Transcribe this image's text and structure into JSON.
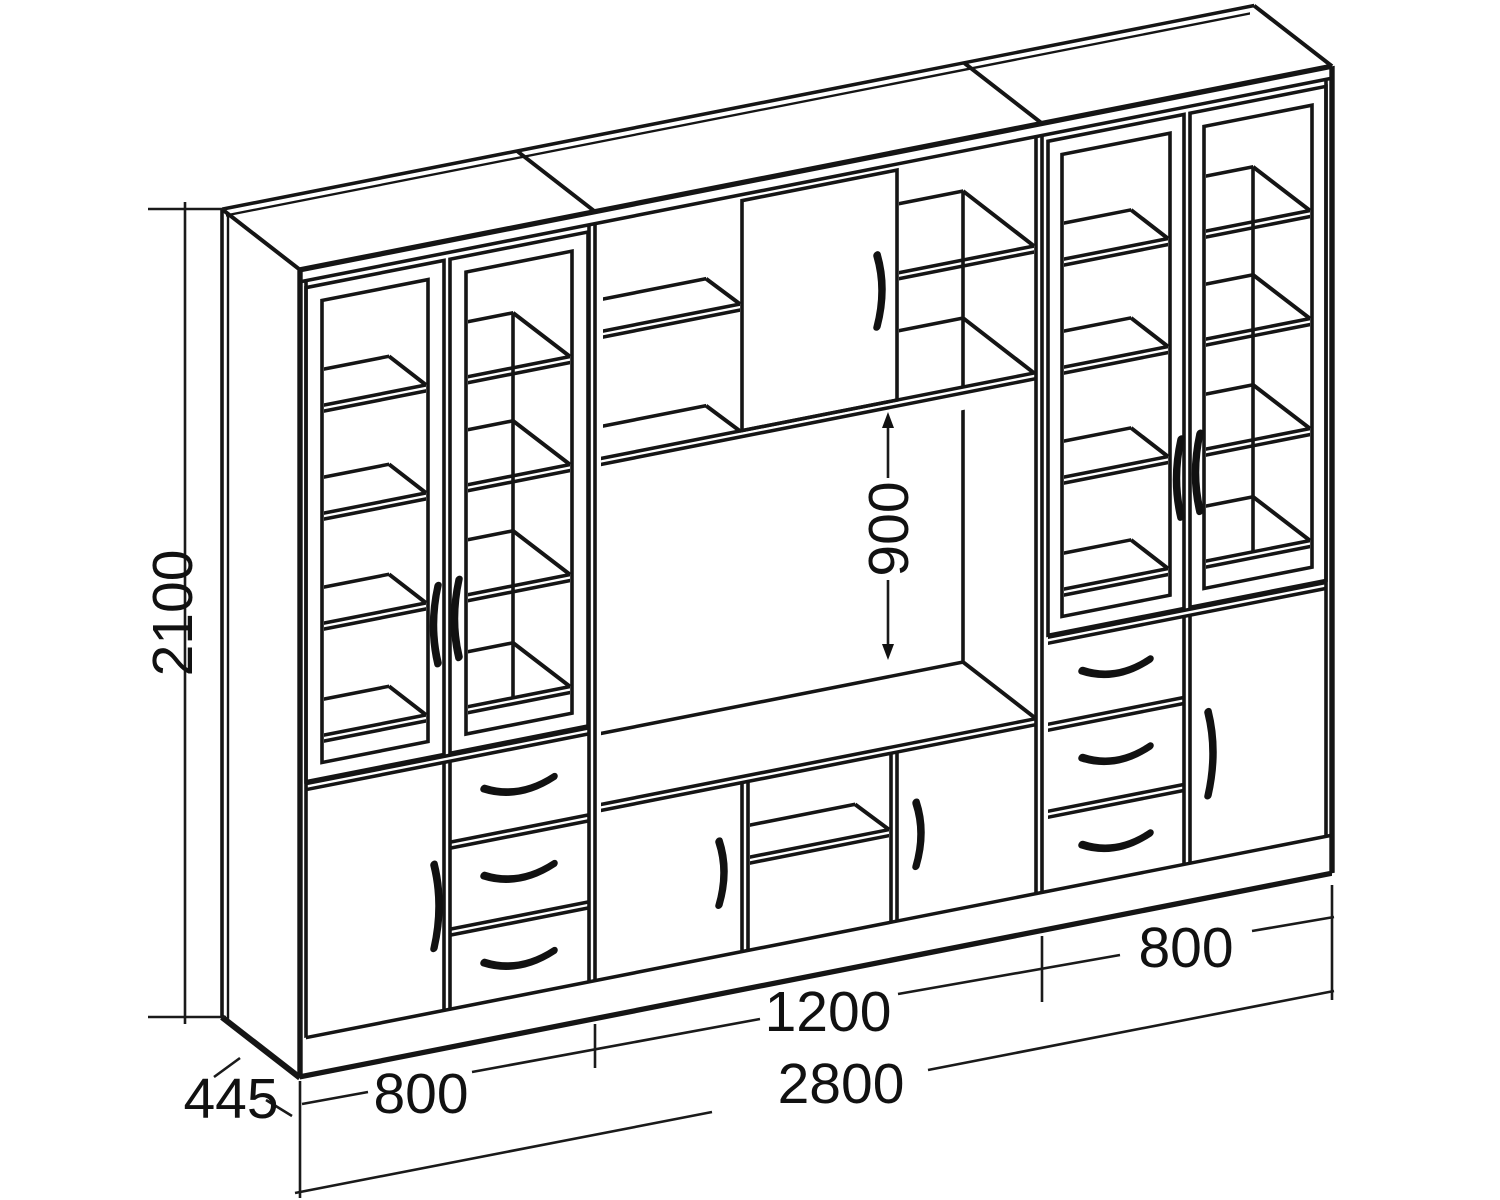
{
  "drawing": {
    "title": "wall-unit-furniture-technical-drawing",
    "line_color": "#151515",
    "background": "#ffffff"
  },
  "dims": {
    "height": "2100",
    "depth": "445",
    "left_width": "800",
    "center_width": "1200",
    "right_width": "800",
    "total_width": "2800",
    "niche_height": "900"
  }
}
